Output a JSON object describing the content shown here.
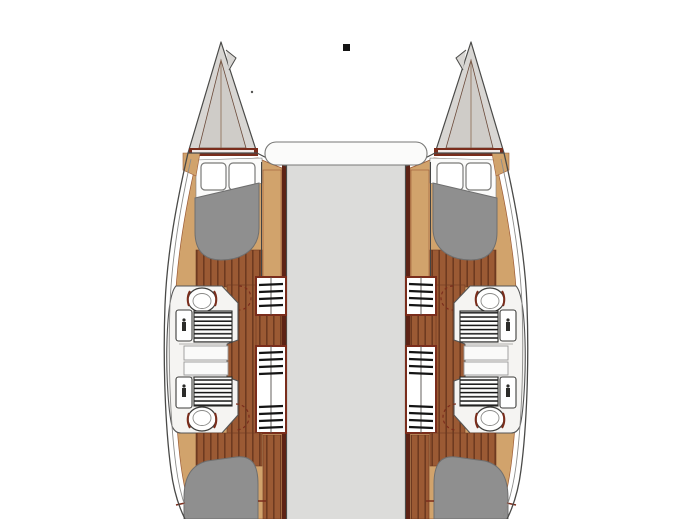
{
  "figure": {
    "kind": "catamaran-deck-floor-plan",
    "view": "top-down",
    "hulls": 2,
    "cabins": 4,
    "heads": 4,
    "visible_text": ""
  },
  "marker": {
    "name": "mast-step-marker",
    "shape": "black-square"
  },
  "palette": {
    "background": "#ffffff",
    "outline": "#4a4a48",
    "hull_shell": "#ffffff",
    "hull_inner_line": "#8c8c8a",
    "bow_fill": "#d8d6d3",
    "bow_inner": "#cfccc8",
    "maroon": "#7a2d1c",
    "maroon_dark": "#5d2315",
    "wood_light": "#d1a36c",
    "wood_edge": "#9c5b36",
    "plank": "#9b5a34",
    "plank_line": "#6e3a20",
    "bed": "#8f8f8f",
    "bed_outline": "#6f6f6f",
    "deck": "#dcdcda",
    "fixture_white": "#f5f4f2",
    "fixture_line": "#555555",
    "grate_line": "#141414",
    "pillow": "#ffffff",
    "pillow_line": "#7a7a78",
    "cabinet_line": "#9a9a98",
    "marker_color": "#141414"
  },
  "parts": {
    "left_hull": "port-hull",
    "right_hull": "starboard-hull",
    "bow_locker": "anchor-locker",
    "forward_berth": "forward-cabin-island-berth",
    "aft_berth": "aft-cabin-island-berth",
    "pillows": "berth-pillows",
    "head_unit": "bathroom-module",
    "toilet": "marine-toilet",
    "washbasin": "washbasin",
    "shower_grate": "shower-floor-grate",
    "vanity": "vanity-cabinets",
    "steps_forward": "companionway-steps-forward",
    "steps_aft": "companionway-steps-aft",
    "sole": "wood-sole-planking",
    "bridgedeck": "central-bridgedeck",
    "coachroof": "coachroof-front-seat"
  }
}
